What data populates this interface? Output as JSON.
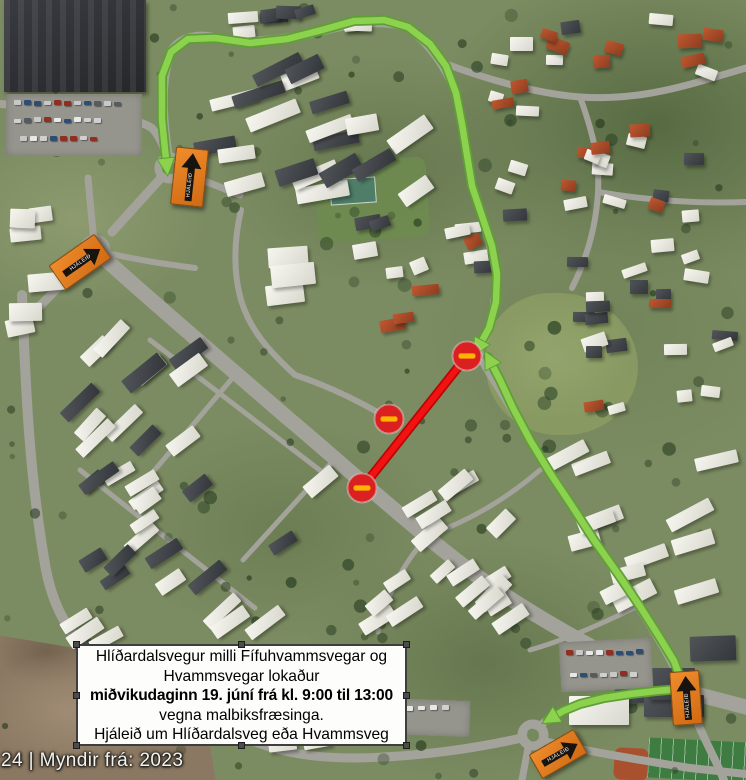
{
  "notice_box": {
    "lines": [
      "Hlíðardalsvegur milli Fífuhvammsvegar og",
      "Hvammsvegar lokaður",
      "miðvikudaginn 19. júní frá kl. 9:00 til 13:00",
      "vegna malbiksfræsinga.",
      "Hjáleið um Hlíðardalsveg eða Hvammsveg"
    ],
    "bold_line_index": 2
  },
  "attribution": "24 | Myndir frá: 2023",
  "signs": {
    "detour_label": "HJÁLEIÐ"
  },
  "colors": {
    "route_green": "#8dd24f",
    "route_green_edge": "#5f9f36",
    "closure_red": "#f21212",
    "closure_red_edge": "#bb0505",
    "detour_sign_orange": "#e0791e",
    "no_entry_red": "#da2020",
    "no_entry_bar": "#ffb400"
  },
  "annotations": {
    "detour_routes": [
      {
        "id": "detour-route-north",
        "points": [
          [
            167,
            169
          ],
          [
            162,
            120
          ],
          [
            162,
            76
          ],
          [
            171,
            52
          ],
          [
            188,
            39
          ],
          [
            215,
            38
          ],
          [
            250,
            43
          ],
          [
            287,
            39
          ],
          [
            322,
            30
          ],
          [
            354,
            21
          ],
          [
            384,
            20
          ],
          [
            408,
            27
          ],
          [
            430,
            44
          ],
          [
            446,
            66
          ],
          [
            456,
            93
          ],
          [
            462,
            124
          ],
          [
            467,
            155
          ],
          [
            472,
            186
          ],
          [
            482,
            216
          ],
          [
            492,
            246
          ],
          [
            497,
            274
          ],
          [
            496,
            302
          ],
          [
            489,
            328
          ],
          [
            477,
            350
          ]
        ],
        "arrows": "both"
      },
      {
        "id": "detour-route-south",
        "points": [
          [
            488,
            357
          ],
          [
            500,
            380
          ],
          [
            513,
            408
          ],
          [
            530,
            440
          ],
          [
            550,
            473
          ],
          [
            572,
            506
          ],
          [
            594,
            540
          ],
          [
            618,
            574
          ],
          [
            641,
            608
          ],
          [
            660,
            638
          ],
          [
            674,
            661
          ],
          [
            681,
            680
          ],
          [
            679,
            689
          ],
          [
            656,
            691
          ],
          [
            630,
            694
          ],
          [
            604,
            698
          ],
          [
            580,
            704
          ],
          [
            563,
            711
          ],
          [
            548,
            720
          ]
        ],
        "arrows": "both"
      }
    ],
    "closed_segment": {
      "points": [
        [
          467,
          356
        ],
        [
          362,
          488
        ]
      ]
    },
    "no_entry_signs": [
      {
        "x": 467,
        "y": 356
      },
      {
        "x": 389,
        "y": 419
      },
      {
        "x": 362,
        "y": 488
      }
    ],
    "detour_signs": [
      {
        "x": 189,
        "y": 177,
        "w": 33,
        "h": 58,
        "rot": 6,
        "dir": "up"
      },
      {
        "x": 80,
        "y": 262,
        "w": 56,
        "h": 30,
        "rot": -35,
        "dir": "right"
      },
      {
        "x": 686,
        "y": 698,
        "w": 30,
        "h": 54,
        "rot": -4,
        "dir": "up"
      },
      {
        "x": 558,
        "y": 754,
        "w": 52,
        "h": 28,
        "rot": -30,
        "dir": "right"
      }
    ]
  }
}
